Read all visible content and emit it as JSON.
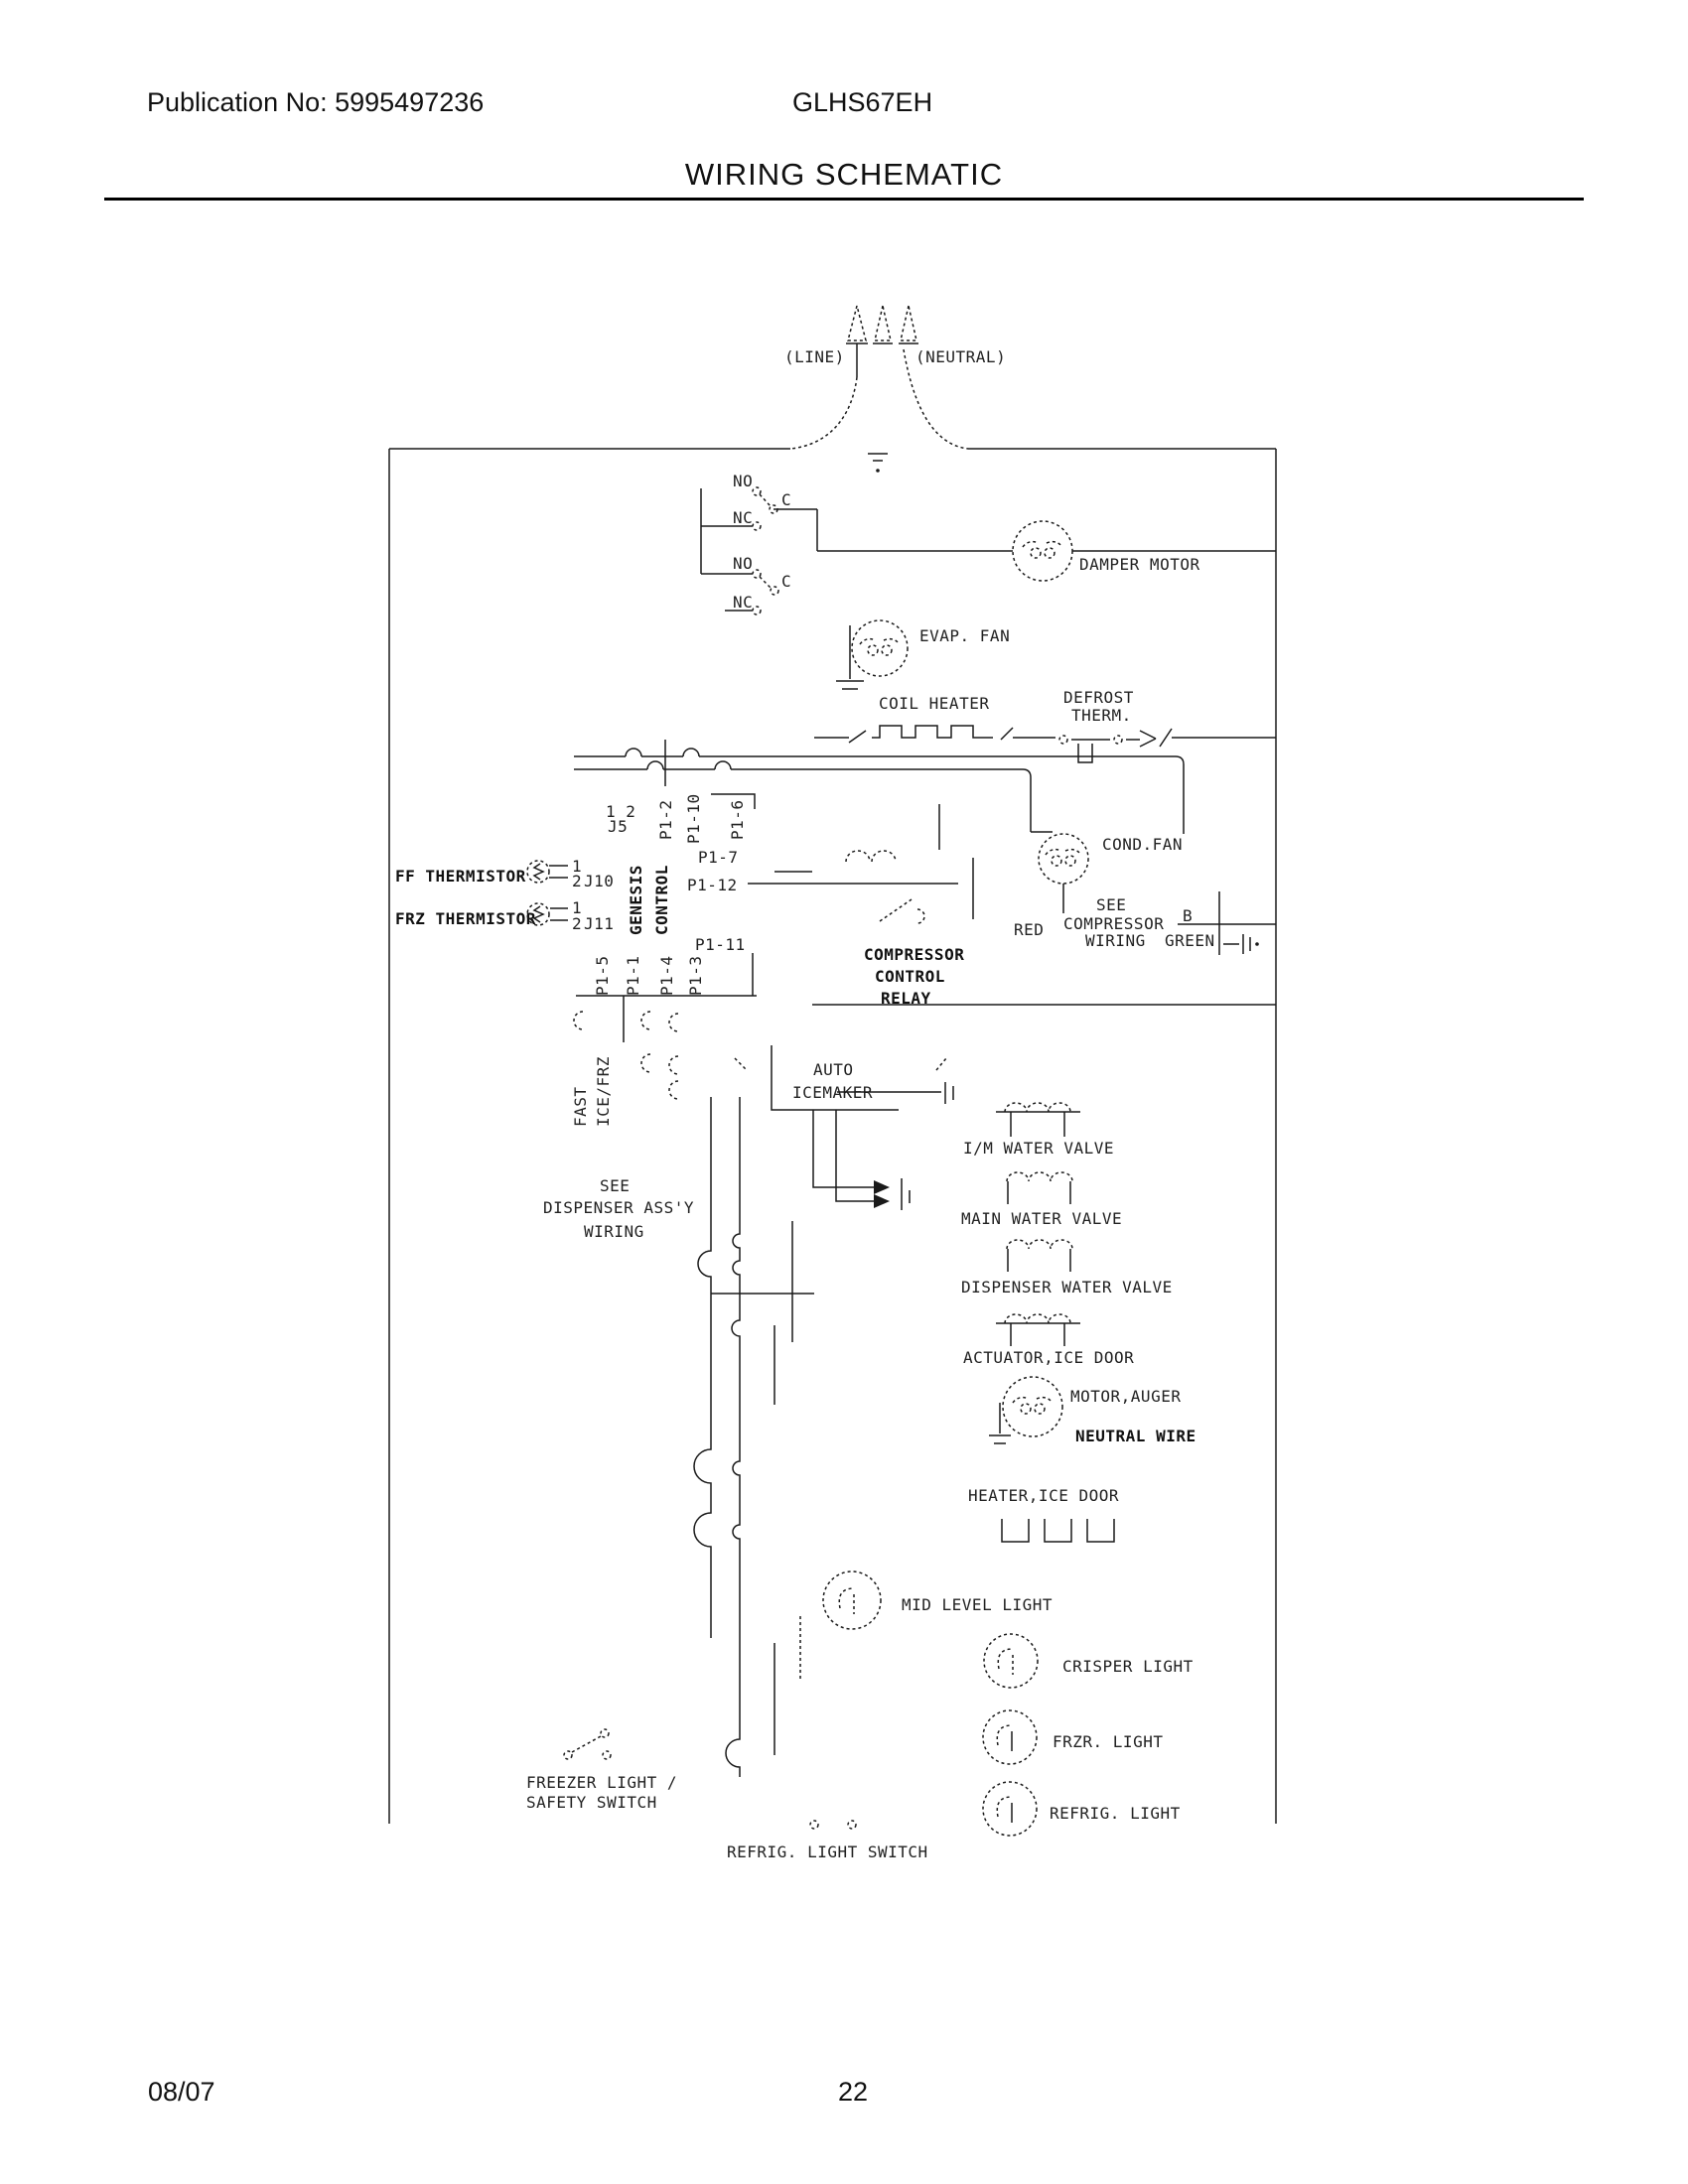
{
  "header": {
    "publication": "Publication No: 5995497236",
    "model": "GLHS67EH",
    "title": "WIRING SCHEMATIC"
  },
  "footer": {
    "date": "08/07",
    "page": "22"
  },
  "power": {
    "line": "(LINE)",
    "neutral": "(NEUTRAL)"
  },
  "switch": {
    "no": "NO",
    "nc": "NC",
    "c": "C"
  },
  "components": {
    "damper_motor": "DAMPER MOTOR",
    "evap_fan": "EVAP. FAN",
    "coil_heater": "COIL HEATER",
    "defrost_therm_line1": "DEFROST",
    "defrost_therm_line2": "THERM.",
    "cond_fan": "COND.FAN",
    "compressor_note_line1": "SEE",
    "compressor_note_line2": "COMPRESSOR",
    "compressor_note_line3": "WIRING",
    "wire_red": "RED",
    "wire_b": "B",
    "wire_green": "GREEN",
    "relay_line1": "COMPRESSOR",
    "relay_line2": "CONTROL",
    "relay_line3": "RELAY",
    "fast": "FAST",
    "ice_frz": "ICE/FRZ",
    "auto_icemaker_line1": "AUTO",
    "auto_icemaker_line2": "ICEMAKER",
    "dispenser_note_line1": "SEE",
    "dispenser_note_line2": "DISPENSER ASS'Y",
    "dispenser_note_line3": "WIRING",
    "im_water_valve": "I/M WATER VALVE",
    "main_water_valve": "MAIN WATER VALVE",
    "dispenser_water_valve": "DISPENSER WATER VALVE",
    "actuator_ice_door": "ACTUATOR,ICE DOOR",
    "motor_auger": "MOTOR,AUGER",
    "neutral_wire": "NEUTRAL WIRE",
    "heater_ice_door": "HEATER,ICE DOOR",
    "mid_level_light": "MID LEVEL LIGHT",
    "crisper_light": "CRISPER LIGHT",
    "frzr_light": "FRZR. LIGHT",
    "refrig_light": "REFRIG. LIGHT",
    "freezer_switch_line1": "FREEZER LIGHT /",
    "freezer_switch_line2": "SAFETY SWITCH",
    "refrig_light_switch": "REFRIG. LIGHT SWITCH"
  },
  "control_board": {
    "genesis": "GENESIS",
    "control": "CONTROL",
    "ff_thermistor": "FF THERMISTOR",
    "frz_thermistor": "FRZ THERMISTOR",
    "pin1": "1",
    "pin2": "2",
    "j10": "J10",
    "j11": "J11",
    "j5": "J5",
    "j5_pins": "1 2",
    "p1_2": "P1-2",
    "p1_10": "P1-10",
    "p1_6": "P1-6",
    "p1_7": "P1-7",
    "p1_12": "P1-12",
    "p1_11": "P1-11",
    "p1_5": "P1-5",
    "p1_1": "P1-1",
    "p1_4": "P1-4",
    "p1_3": "P1-3"
  }
}
